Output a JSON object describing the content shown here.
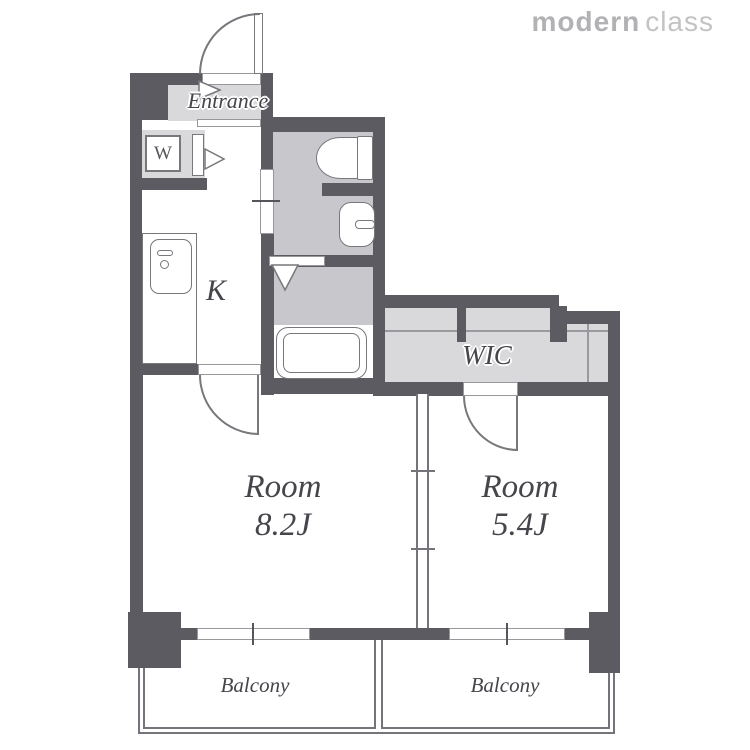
{
  "logo": {
    "bold": "modern",
    "light": "class"
  },
  "labels": {
    "entrance": "Entrance",
    "washer": "W",
    "kitchen": "K",
    "wic": "WIC",
    "balcony_left": "Balcony",
    "balcony_right": "Balcony"
  },
  "rooms": [
    {
      "name": "Room",
      "size": "8.2J"
    },
    {
      "name": "Room",
      "size": "5.4J"
    }
  ],
  "colors": {
    "wall": "#5b5b61",
    "floor_light": "#d9d9dc",
    "floor_mid": "#c8c8cc",
    "fixture_line": "#77777c",
    "label_text": "#45454b",
    "logo_bold": "#b2b2b5",
    "logo_light": "#c3c3c6"
  }
}
